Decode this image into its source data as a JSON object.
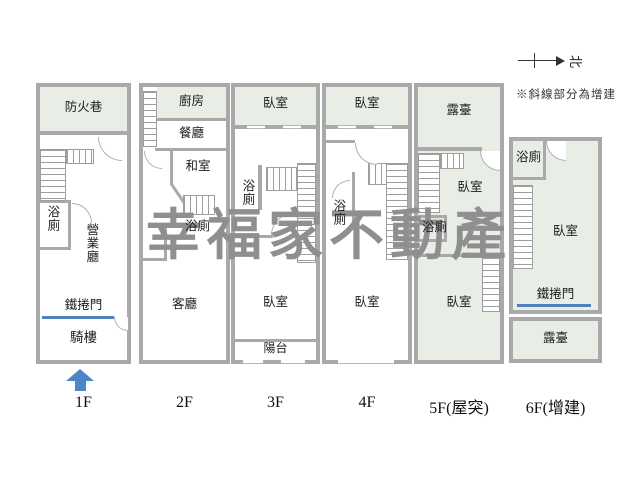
{
  "watermark": {
    "text": "幸福家不動產",
    "color": "#8f8f8f"
  },
  "legend": {
    "note": "※斜線部分為增建",
    "north_label": "北"
  },
  "colors": {
    "wall": "#a9a9a9",
    "addition_green": "#e8eee6",
    "shutter_blue": "#4f81bd",
    "arrow_blue": "#4a86c8"
  },
  "floors": [
    {
      "label": "1F",
      "rooms": {
        "fire_lane": "防火巷",
        "bath": "浴廁",
        "business_hall": "營業廳",
        "roller_door": "鐵捲門",
        "arcade": "騎樓"
      }
    },
    {
      "label": "2F",
      "rooms": {
        "kitchen": "廚房",
        "dining": "餐廳",
        "tatami": "和室",
        "bath": "浴廁",
        "living": "客廳"
      }
    },
    {
      "label": "3F",
      "rooms": {
        "bedroom_top": "臥室",
        "bath": "浴廁",
        "bedroom": "臥室",
        "balcony": "陽台"
      }
    },
    {
      "label": "4F",
      "rooms": {
        "bedroom_top": "臥室",
        "bath": "浴廁",
        "bedroom": "臥室"
      }
    },
    {
      "label": "5F(屋突)",
      "rooms": {
        "terrace": "露臺",
        "bedroom_top": "臥室",
        "bath": "浴廁",
        "bedroom": "臥室"
      }
    },
    {
      "label": "6F(增建)",
      "rooms": {
        "bath": "浴廁",
        "bedroom": "臥室",
        "roller_door": "鐵捲門",
        "terrace": "露臺"
      }
    }
  ]
}
